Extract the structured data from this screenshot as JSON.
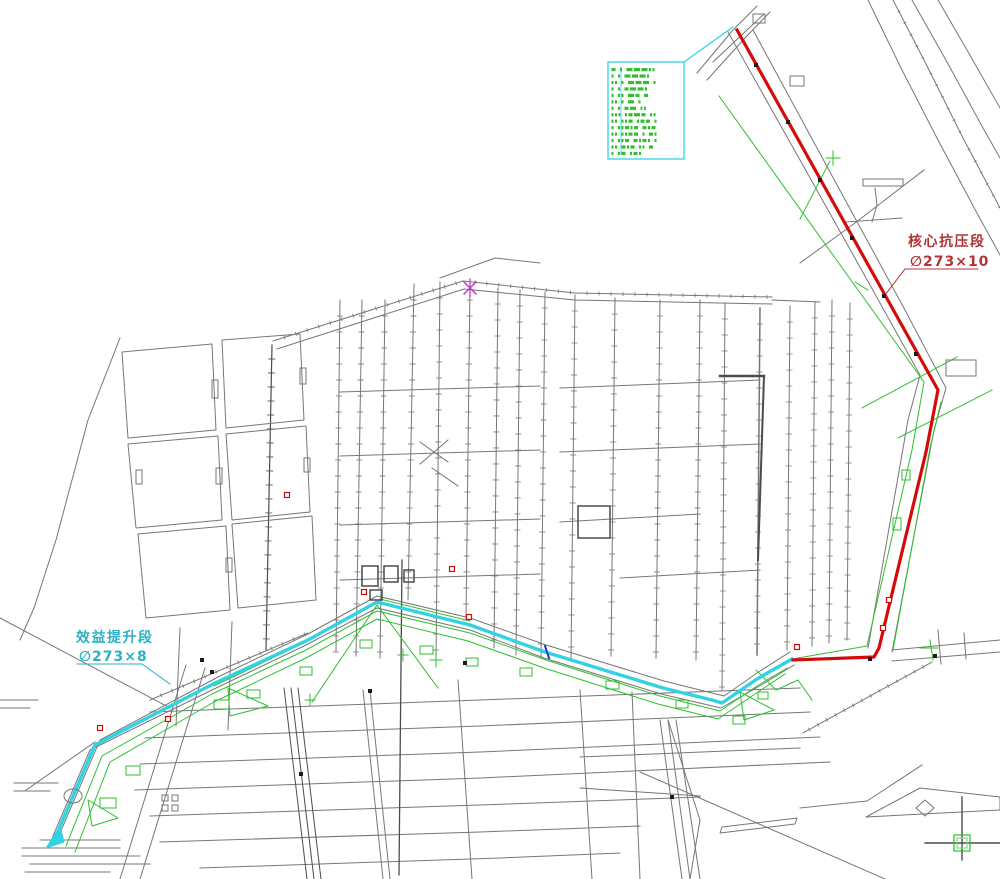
{
  "labels": {
    "red_section": {
      "name": "核心抗压段",
      "spec": "∅273×10"
    },
    "cyan_section": {
      "name": "效益提升段",
      "spec": "∅273×8"
    }
  },
  "colors": {
    "gray": "#767676",
    "dgray": "#4c4c4c",
    "green": "#2fbf2f",
    "lgreen": "#7fdc7f",
    "red": "#d40b0b",
    "cyan": "#31d2e4",
    "magenta": "#c633c6",
    "blue": "#2433cc",
    "black": "#1b1b1b",
    "label_red": "#b23434",
    "label_cyan": "#2cb2c4",
    "white": "#ffffff"
  },
  "legend": {
    "x": 608,
    "y": 62,
    "w": 76,
    "h": 97,
    "rows": [
      "2 1 33311",
      "1 1 3331",
      "11 1 333 1",
      "1 1 2331",
      "1 11 32 2",
      "11 1 3 1",
      "1 1 23 11",
      "111 1232 11",
      "11 112 122 1",
      "1 11212 212",
      "11 1122 1 21",
      "1 112 2121 1",
      "11 212 11 2",
      "1 12 121"
    ]
  },
  "map": {
    "features": [
      {
        "p": "868,0 902,70 938,140 978,215 1000,255"
      },
      {
        "p": "893,0 925,62 963,138 1000,208",
        "t": 13,
        "l": 3
      },
      {
        "p": "912,0 947,62 983,128 1000,158"
      },
      {
        "p": "938,0 967,50 1000,108"
      },
      {
        "p": "697,73 733,30 757,6"
      },
      {
        "p": "707,80 745,38 770,12"
      },
      {
        "p": "728,32 800,160 870,285 920,375"
      },
      {
        "p": "753,30 830,172 905,310 946,388"
      },
      {
        "p": "920,375 908,420 868,648"
      },
      {
        "p": "946,388 934,430 892,652"
      },
      {
        "p": "713,62 764,14"
      },
      {
        "p": "875,188 877,205 872,222"
      },
      {
        "p": "846,222 902,218"
      },
      {
        "p": "800,263 855,223 924,170"
      },
      {
        "p": "892,650 1000,640"
      },
      {
        "p": "892,661 1000,652"
      },
      {
        "p": "938,630 941,664"
      },
      {
        "p": "964,633 966,659"
      },
      {
        "p": "273,341 463,281",
        "t": 12,
        "l": 4
      },
      {
        "p": "277,349 464,289"
      },
      {
        "p": "463,281 575,293 772,297",
        "t": 12,
        "l": 4
      },
      {
        "p": "464,289 575,300 772,304"
      },
      {
        "p": "440,278 495,258 540,263"
      },
      {
        "p": "772,300 820,302"
      },
      {
        "p": "340,300 336,652",
        "t": 16,
        "l": 6
      },
      {
        "p": "362,300 356,656",
        "t": 16,
        "l": 6
      },
      {
        "p": "385,300 380,658",
        "t": 16,
        "l": 6
      },
      {
        "p": "414,284 408,600",
        "t": 16,
        "l": 6
      },
      {
        "p": "440,282 436,660",
        "t": 16,
        "l": 6
      },
      {
        "p": "470,284 466,620",
        "t": 16,
        "l": 6
      },
      {
        "p": "498,288 494,648",
        "t": 16,
        "l": 6
      },
      {
        "p": "520,290 516,655",
        "t": 16,
        "l": 6
      },
      {
        "p": "545,292 541,657",
        "t": 16,
        "l": 6
      },
      {
        "p": "575,295 571,660",
        "t": 16,
        "l": 6
      },
      {
        "p": "615,298 611,656",
        "t": 16,
        "l": 6
      },
      {
        "p": "660,300 656,658",
        "t": 16,
        "l": 6
      },
      {
        "p": "700,300 696,660",
        "t": 16,
        "l": 6
      },
      {
        "p": "725,303 722,690",
        "t": 16,
        "l": 6
      },
      {
        "p": "760,308 757,655",
        "w": 1.5,
        "t": 16,
        "l": 6
      },
      {
        "p": "790,306 787,650",
        "t": 16,
        "l": 6
      },
      {
        "p": "815,302 812,646",
        "t": 16,
        "l": 6
      },
      {
        "p": "832,300 829,643",
        "t": 16,
        "l": 6
      },
      {
        "p": "850,303 847,640",
        "t": 16,
        "l": 6
      },
      {
        "p": "272,345 266,650",
        "c": "dgray",
        "w": 1.2,
        "t": 14,
        "l": 7
      },
      {
        "p": "122,352 212,344 216,430 128,438",
        "x": 1
      },
      {
        "p": "128,444 218,436 222,520 136,528",
        "x": 1
      },
      {
        "p": "222,340 300,334 304,420 226,428",
        "x": 1
      },
      {
        "p": "226,434 306,426 310,512 232,520",
        "x": 1
      },
      {
        "p": "138,534 226,526 230,610 146,618",
        "x": 1
      },
      {
        "p": "232,524 312,516 316,600 238,608",
        "x": 1
      },
      {
        "p": "120,338 88,420 56,540 34,608 20,640"
      },
      {
        "p": "0,618 170,708"
      },
      {
        "p": "0,700 38,700"
      },
      {
        "p": "0,708 30,708"
      },
      {
        "p": "22,848 120,848"
      },
      {
        "p": "22,856 140,856"
      },
      {
        "p": "30,864 150,864"
      },
      {
        "p": "25,872 110,872"
      },
      {
        "p": "40,840 120,840"
      },
      {
        "p": "26,790 95,742"
      },
      {
        "p": "14,783 58,783"
      },
      {
        "p": "14,791 50,791"
      },
      {
        "p": "340,392 540,386"
      },
      {
        "p": "340,456 540,450"
      },
      {
        "p": "340,525 540,519"
      },
      {
        "p": "340,580 540,574"
      },
      {
        "p": "560,388 760,380"
      },
      {
        "p": "560,452 760,444"
      },
      {
        "p": "560,522 700,514"
      },
      {
        "p": "620,578 760,570"
      },
      {
        "p": "150,712 480,700 800,688"
      },
      {
        "p": "145,738 480,726 810,712"
      },
      {
        "p": "140,764 480,752 820,737"
      },
      {
        "p": "135,790 480,778 830,762"
      },
      {
        "p": "150,816 480,805 700,797"
      },
      {
        "p": "160,842 480,832 640,826"
      },
      {
        "p": "200,868 500,858 620,853"
      },
      {
        "p": "284,688 307,879",
        "c": "dgray"
      },
      {
        "p": "291,688 314,879",
        "c": "dgray"
      },
      {
        "p": "298,688 321,879",
        "c": "dgray"
      },
      {
        "p": "363,690 383,879"
      },
      {
        "p": "370,690 390,879"
      },
      {
        "p": "402,560 399,875",
        "c": "dgray",
        "w": 1.3
      },
      {
        "p": "458,680 472,879"
      },
      {
        "p": "580,690 592,879"
      },
      {
        "p": "632,692 640,879"
      },
      {
        "p": "660,720 682,879"
      },
      {
        "p": "668,720 690,879"
      },
      {
        "p": "676,720 700,879"
      },
      {
        "p": "668,720 700,820 690,879"
      },
      {
        "p": "580,757 800,748"
      },
      {
        "p": "580,788 700,796"
      },
      {
        "p": "932,662 803,733",
        "t": 10,
        "l": 4
      },
      {
        "p": "640,772 885,879"
      },
      {
        "p": "800,808 867,801 922,765"
      },
      {
        "p": "866,817 920,788 1000,797 1000,810",
        "x": 1
      },
      {
        "p": "722,827 797,818 795,824 720,833",
        "x": 1
      },
      {
        "p": "186,665 120,879"
      },
      {
        "p": "205,668 140,879"
      },
      {
        "p": "232,622 228,730"
      },
      {
        "p": "180,628 176,726"
      },
      {
        "p": "420,442 448,462"
      },
      {
        "p": "448,440 420,464"
      },
      {
        "p": "432,468 458,486"
      },
      {
        "p": "720,376 764,376",
        "c": "dgray",
        "w": 2.5
      },
      {
        "p": "764,376 758,560",
        "c": "dgray",
        "w": 2
      },
      {
        "p": "60,833 100,740 218,677 308,634 377,596 470,618 546,645 664,681 724,696 760,671 790,652"
      },
      {
        "p": "50,843 90,750 212,690 304,646 377,608 470,630 544,658 661,694 721,708 763,684 794,665"
      },
      {
        "p": "150,700 308,633",
        "t": 12,
        "l": 4
      },
      {
        "p": "66,846 102,756 212,694 306,650 377,611 470,633 546,660 660,696 720,711 757,686 787,668",
        "c": "green"
      },
      {
        "p": "75,852 110,762 214,702 306,658 377,619 468,641 544,668 658,704 718,719 755,694 785,674",
        "c": "green"
      },
      {
        "p": "214,686 306,642",
        "c": "green"
      },
      {
        "p": "380,599 470,621",
        "c": "green"
      },
      {
        "p": "719,96 924,382 912,450 867,646 792,659",
        "c": "green"
      },
      {
        "p": "941,402 930,448 893,650",
        "c": "green"
      },
      {
        "p": "862,408 957,357",
        "c": "green"
      },
      {
        "p": "898,438 992,390",
        "c": "green"
      },
      {
        "p": "800,219 830,161",
        "c": "green"
      },
      {
        "p": "826,158 840,158",
        "c": "green"
      },
      {
        "p": "833,151 833,165",
        "c": "green"
      },
      {
        "p": "855,282 868,290",
        "c": "green"
      },
      {
        "p": "377,605 312,702",
        "c": "green"
      },
      {
        "p": "377,605 438,688",
        "c": "green"
      },
      {
        "p": "228,688 268,706 230,716",
        "x": 1,
        "c": "green"
      },
      {
        "p": "740,692 774,710 744,720",
        "x": 1,
        "c": "green"
      },
      {
        "p": "88,800 118,818 92,826",
        "x": 1,
        "c": "green"
      },
      {
        "p": "756,670 776,690 798,680 812,700",
        "c": "green"
      },
      {
        "p": "920,648 938,648",
        "c": "green"
      },
      {
        "p": "930,640 933,660",
        "c": "green"
      },
      {
        "p": "430,660 442,660",
        "c": "green"
      },
      {
        "p": "436,653 436,667",
        "c": "green"
      },
      {
        "p": "398,655 408,655",
        "c": "green"
      },
      {
        "p": "403,649 403,661",
        "c": "green"
      },
      {
        "p": "305,700 315,700",
        "c": "green"
      },
      {
        "p": "310,694 310,706",
        "c": "green"
      },
      {
        "p": "55,838 95,745 215,683 308,640 377,602 470,625 545,652 663,688 712,700 722,703 757,679 792,659",
        "c": "cyan",
        "w": 3.4,
        "n": "cyan-pipeline-route"
      },
      {
        "p": "46,848 60,826 64,842",
        "c": "cyan",
        "x": 1,
        "f": 1,
        "n": "cyan-pipeline-end"
      },
      {
        "p": "737,30 938,390 926,452 879,648 874,657 793,660",
        "c": "red",
        "w": 3.2,
        "n": "red-pipeline-route"
      },
      {
        "p": "545,646 549,658",
        "c": "blue",
        "w": 2,
        "n": "blue-survey-tick"
      },
      {
        "p": "684,62 733,27",
        "c": "cyan",
        "w": 1.2,
        "n": "legend-leader-line"
      },
      {
        "p": "905,269 978,269",
        "c": "label_red",
        "n": "red-label-underline"
      },
      {
        "p": "905,269 885,295",
        "c": "label_red",
        "n": "red-label-leader"
      },
      {
        "p": "77,664 142,664",
        "c": "label_cyan",
        "n": "cyan-label-underline"
      },
      {
        "p": "142,664 170,684",
        "c": "label_cyan",
        "n": "cyan-label-leader"
      },
      {
        "p": "925,843 1000,843",
        "c": "dgray",
        "w": 1.4,
        "n": "crosshair-horizontal"
      },
      {
        "p": "962,797 962,860",
        "c": "dgray",
        "w": 1.4,
        "n": "crosshair-vertical"
      },
      {
        "p": "916,808 925,800 934,808 925,816",
        "x": 1
      },
      {
        "p": "464,282 476,294",
        "c": "magenta",
        "w": 1.4,
        "n": "magenta-survey-mark"
      },
      {
        "p": "476,282 464,294",
        "c": "magenta",
        "w": 1.4,
        "n": "magenta-survey-mark"
      },
      {
        "p": "470,279 470,297",
        "c": "magenta",
        "w": 1.2,
        "n": "magenta-survey-mark"
      }
    ],
    "rects": [
      [
        863,
        179,
        40,
        7,
        "gray",
        1
      ],
      [
        946,
        360,
        30,
        16,
        "gray",
        1
      ],
      [
        753,
        14,
        12,
        9,
        "gray",
        1
      ],
      [
        790,
        76,
        14,
        10,
        "gray",
        1
      ],
      [
        212,
        380,
        6,
        18,
        "gray",
        1
      ],
      [
        216,
        468,
        6,
        16,
        "gray",
        1
      ],
      [
        300,
        368,
        6,
        16,
        "gray",
        1
      ],
      [
        304,
        458,
        6,
        14,
        "gray",
        1
      ],
      [
        226,
        558,
        6,
        14,
        "gray",
        1
      ],
      [
        136,
        470,
        6,
        14,
        "gray",
        1
      ],
      [
        578,
        506,
        32,
        32,
        "dgray",
        1.5
      ],
      [
        362,
        566,
        16,
        20,
        "dgray",
        1.5
      ],
      [
        384,
        566,
        14,
        16,
        "dgray",
        1.5
      ],
      [
        404,
        570,
        10,
        12,
        "dgray",
        1.5
      ],
      [
        370,
        590,
        12,
        10,
        "dgray",
        1.5
      ],
      [
        162,
        795,
        6,
        6,
        "gray",
        1
      ],
      [
        172,
        795,
        6,
        6,
        "gray",
        1
      ],
      [
        162,
        805,
        6,
        6,
        "gray",
        1
      ],
      [
        172,
        805,
        6,
        6,
        "gray",
        1
      ],
      [
        100,
        798,
        16,
        10,
        "green",
        1
      ],
      [
        126,
        766,
        14,
        9,
        "green",
        1
      ],
      [
        214,
        700,
        15,
        9,
        "green",
        1
      ],
      [
        247,
        690,
        13,
        8,
        "green",
        1
      ],
      [
        300,
        667,
        12,
        8,
        "green",
        1
      ],
      [
        360,
        640,
        12,
        8,
        "green",
        1
      ],
      [
        420,
        646,
        13,
        8,
        "green",
        1
      ],
      [
        466,
        658,
        12,
        8,
        "green",
        1
      ],
      [
        520,
        668,
        12,
        8,
        "green",
        1
      ],
      [
        606,
        681,
        13,
        8,
        "green",
        1
      ],
      [
        676,
        700,
        12,
        8,
        "green",
        1
      ],
      [
        733,
        716,
        12,
        8,
        "green",
        1
      ],
      [
        758,
        692,
        10,
        7,
        "green",
        1
      ],
      [
        893,
        518,
        8,
        12,
        "green",
        1
      ],
      [
        902,
        470,
        8,
        10,
        "green",
        1
      ],
      [
        954,
        835,
        16,
        16,
        "green",
        1.2
      ],
      [
        957,
        838,
        10,
        10,
        "lgreen",
        1.2
      ]
    ],
    "ellipses": [
      {
        "cx": 73,
        "cy": 796,
        "rx": 9,
        "ry": 7,
        "c": "gray"
      }
    ],
    "black_squares": [
      [
        756,
        65
      ],
      [
        788,
        122
      ],
      [
        820,
        180
      ],
      [
        852,
        238
      ],
      [
        884,
        296
      ],
      [
        916,
        354
      ],
      [
        870,
        659
      ],
      [
        935,
        656
      ],
      [
        301,
        774
      ],
      [
        370,
        691
      ],
      [
        465,
        663
      ],
      [
        202,
        660
      ],
      [
        212,
        672
      ],
      [
        672,
        797
      ]
    ],
    "red_squares": [
      [
        452,
        569
      ],
      [
        364,
        592
      ],
      [
        469,
        617
      ],
      [
        100,
        728
      ],
      [
        168,
        719
      ],
      [
        287,
        495
      ],
      [
        797,
        647
      ],
      [
        883,
        628
      ],
      [
        889,
        600
      ]
    ]
  }
}
